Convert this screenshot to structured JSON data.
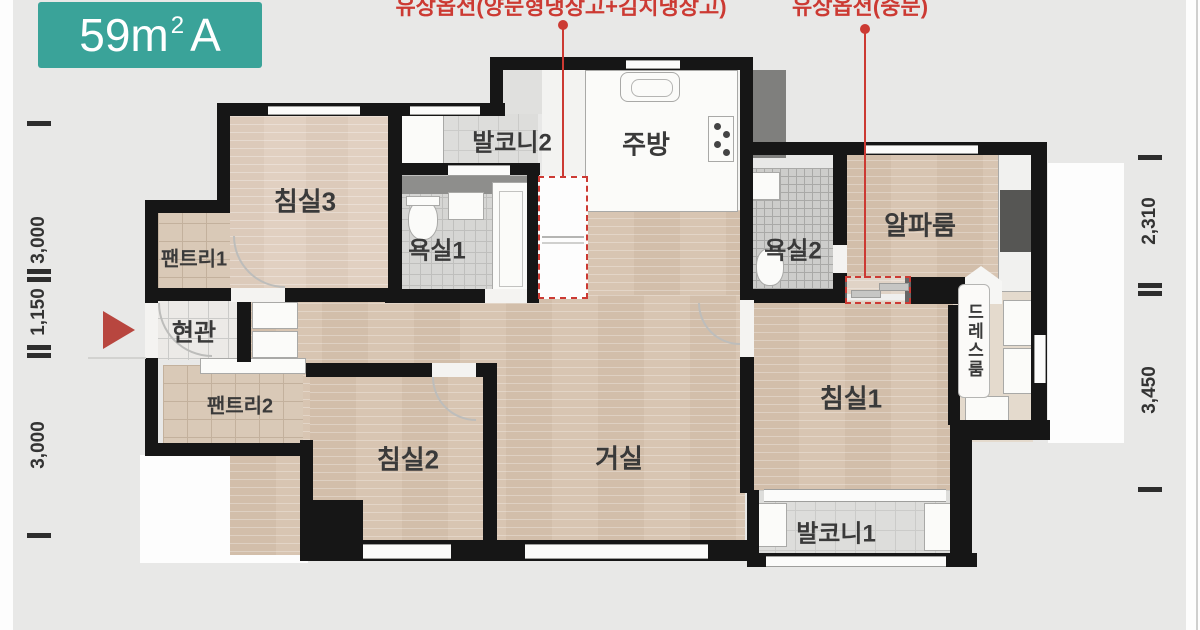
{
  "badge": {
    "size": "59m",
    "superscript": "2",
    "type": "A"
  },
  "annotations": {
    "option_fridge": "유상옵션(양문형냉장고+김치냉장고)",
    "option_door": "유상옵션(중문)"
  },
  "rooms": {
    "bedroom3": "침실3",
    "balcony2": "발코니2",
    "kitchen": "주방",
    "bathroom1": "욕실1",
    "bathroom2": "욕실2",
    "alpha_room": "알파룸",
    "pantry1": "팬트리1",
    "entrance": "현관",
    "pantry2": "팬트리2",
    "bedroom2": "침실2",
    "living_room": "거실",
    "bedroom1": "침실1",
    "balcony1": "발코니1",
    "dress_room": "드레스룸"
  },
  "dimensions": {
    "left_top": "3,000",
    "left_middle": "1,150",
    "left_bottom": "3,000",
    "right_top": "2,310",
    "right_bottom": "3,450"
  },
  "colors": {
    "badge_teal": "#3aa399",
    "annotation_red": "#cc3a33",
    "wall_black": "#161616",
    "wood_floor": "#d8c5b2",
    "background_gray": "#e8e8e7"
  }
}
